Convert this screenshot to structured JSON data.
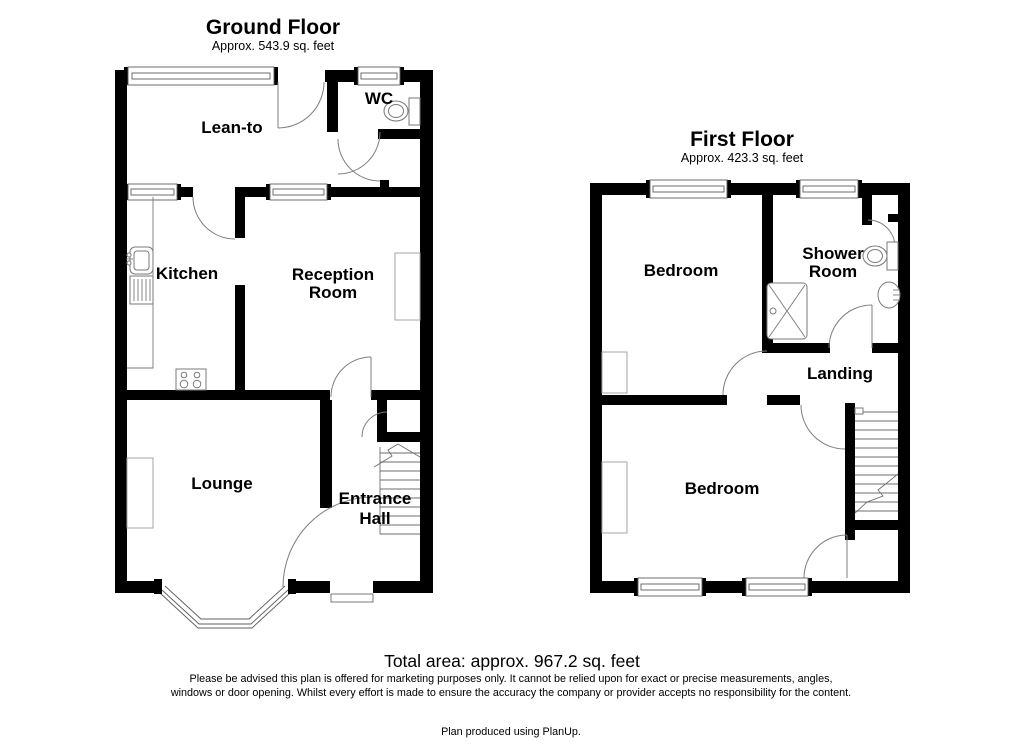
{
  "page": {
    "background": "#ffffff",
    "wall_color": "#000000",
    "line_color": "#7d7d7d",
    "text_color": "#000000"
  },
  "ground_floor": {
    "title": "Ground Floor",
    "area": "Approx. 543.9 sq. feet",
    "rooms": {
      "lean_to": "Lean-to",
      "wc": "WC",
      "kitchen": "Kitchen",
      "reception_line1": "Reception",
      "reception_line2": "Room",
      "lounge": "Lounge",
      "hall_line1": "Entrance",
      "hall_line2": "Hall"
    },
    "icons": [
      "window-icon",
      "door-arc-icon",
      "toilet-icon",
      "kitchen-sink-icon",
      "cooker-hob-icon",
      "staircase-icon",
      "bay-window-icon"
    ]
  },
  "first_floor": {
    "title": "First Floor",
    "area": "Approx. 423.3 sq. feet",
    "rooms": {
      "bedroom_front": "Bedroom",
      "shower_line1": "Shower",
      "shower_line2": "Room",
      "landing": "Landing",
      "bedroom_back": "Bedroom"
    },
    "icons": [
      "window-icon",
      "door-arc-icon",
      "toilet-icon",
      "basin-icon",
      "shower-tray-icon",
      "staircase-icon"
    ]
  },
  "footer": {
    "total_area": "Total area: approx. 967.2 sq. feet",
    "disclaimer_line1": "Please be advised this plan is offered for marketing purposes only. It cannot be relied upon for exact or precise measurements, angles,",
    "disclaimer_line2": "windows or door opening. Whilst every effort is made to ensure the accuracy the company or provider accepts no responsibility for the content.",
    "credit": "Plan produced using PlanUp."
  }
}
